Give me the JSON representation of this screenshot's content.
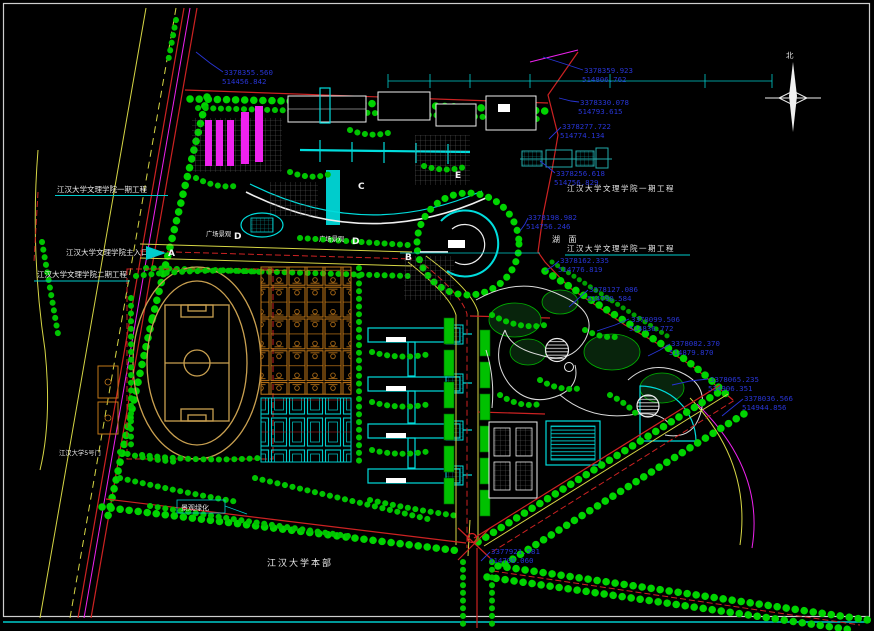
{
  "labels": {
    "phase1_left": "江汉大学文理学院一期工程",
    "main_entrance": "江汉大学文理学院主入口",
    "phase2_left": "江汉大学文理学院二期工程",
    "phase1_right_top": "江汉大学文理学院一期工程",
    "phase1_right_mid": "江汉大学文理学院一期工程",
    "lake": "湖  面",
    "main_campus": "江汉大学本部",
    "plaza_1": "广场景观",
    "plaza_2": "广场景观",
    "gate5": "江汉大学5号门",
    "greening": "景观绿化",
    "north_char": "北"
  },
  "markers": {
    "a": "A",
    "b": "B",
    "c": "C",
    "d1": "D",
    "d2": "D",
    "e": "E"
  },
  "coordinates": [
    {
      "n": "3378355.560",
      "e": "514456.842"
    },
    {
      "n": "3378359.923",
      "e": "514806.762"
    },
    {
      "n": "3378330.078",
      "e": "514793.615"
    },
    {
      "n": "3378277.722",
      "e": "514774.134"
    },
    {
      "n": "3378256.618",
      "e": "514756.829"
    },
    {
      "n": "3378198.982",
      "e": "514756.246"
    },
    {
      "n": "3378162.335",
      "e": "514776.819"
    },
    {
      "n": "3378127.086",
      "e": "514790.584"
    },
    {
      "n": "3378099.506",
      "e": "514836.772"
    },
    {
      "n": "3378082.370",
      "e": "514879.870"
    },
    {
      "n": "3378065.235",
      "e": "514906.351"
    },
    {
      "n": "3378036.566",
      "e": "514944.856"
    },
    {
      "n": "3377921.581",
      "e": "514708.060"
    }
  ],
  "colors": {
    "background": "#000000",
    "tree_green": "#00d400",
    "cyan": "#00dddd",
    "boundary_red": "#cc2222",
    "magenta": "#ee22ee",
    "track_tan": "#c9a050",
    "court_orange": "#c27818",
    "coord_blue": "#2835d6",
    "label_white": "#e9e9e9",
    "road_yellow": "#d6d645"
  }
}
